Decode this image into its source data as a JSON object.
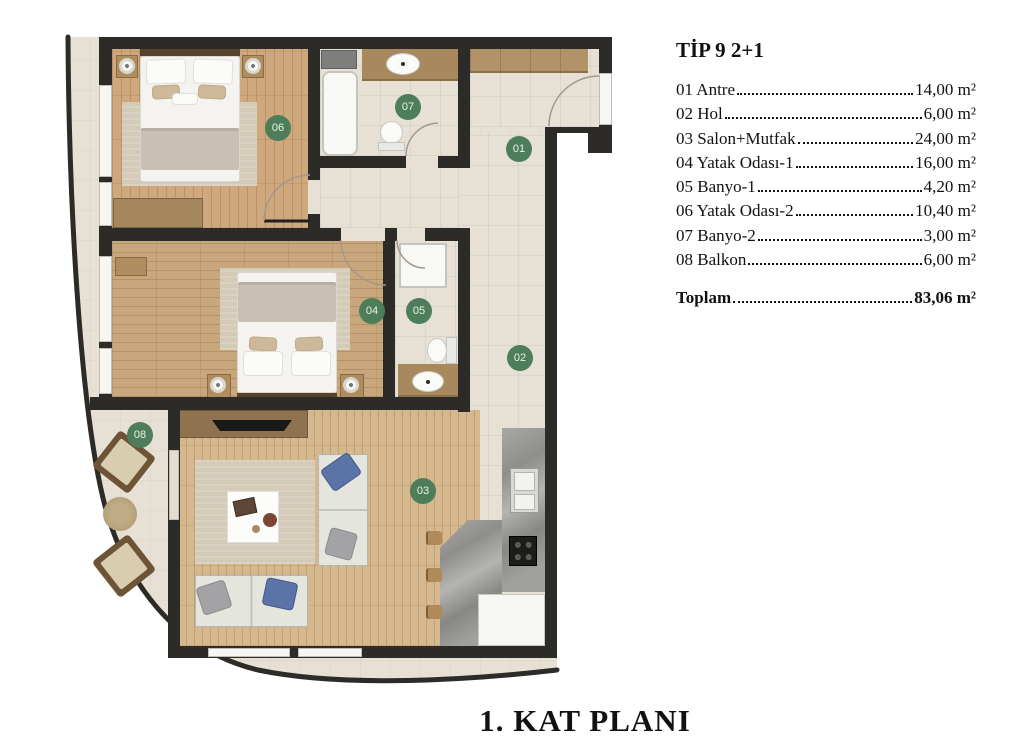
{
  "legend": {
    "title": "TİP 9 2+1",
    "rooms": [
      {
        "id": "01",
        "label": "01 Antre",
        "area": "14,00 m²"
      },
      {
        "id": "02",
        "label": "02 Hol",
        "area": "6,00 m²"
      },
      {
        "id": "03",
        "label": "03 Salon+Mutfak",
        "area": "24,00 m²"
      },
      {
        "id": "04",
        "label": "04 Yatak Odası-1",
        "area": "16,00 m²"
      },
      {
        "id": "05",
        "label": "05 Banyo-1",
        "area": "4,20 m²"
      },
      {
        "id": "06",
        "label": "06 Yatak Odası-2",
        "area": "10,40 m²"
      },
      {
        "id": "07",
        "label": "07 Banyo-2",
        "area": "3,00 m²"
      },
      {
        "id": "08",
        "label": "08 Balkon",
        "area": "6,00 m²"
      }
    ],
    "total": {
      "label": "Toplam",
      "area": "83,06 m²"
    }
  },
  "plan": {
    "caption": "1. KAT PLANI",
    "badge_color": "#4e7d5a",
    "wall_color": "#2d2b28"
  }
}
